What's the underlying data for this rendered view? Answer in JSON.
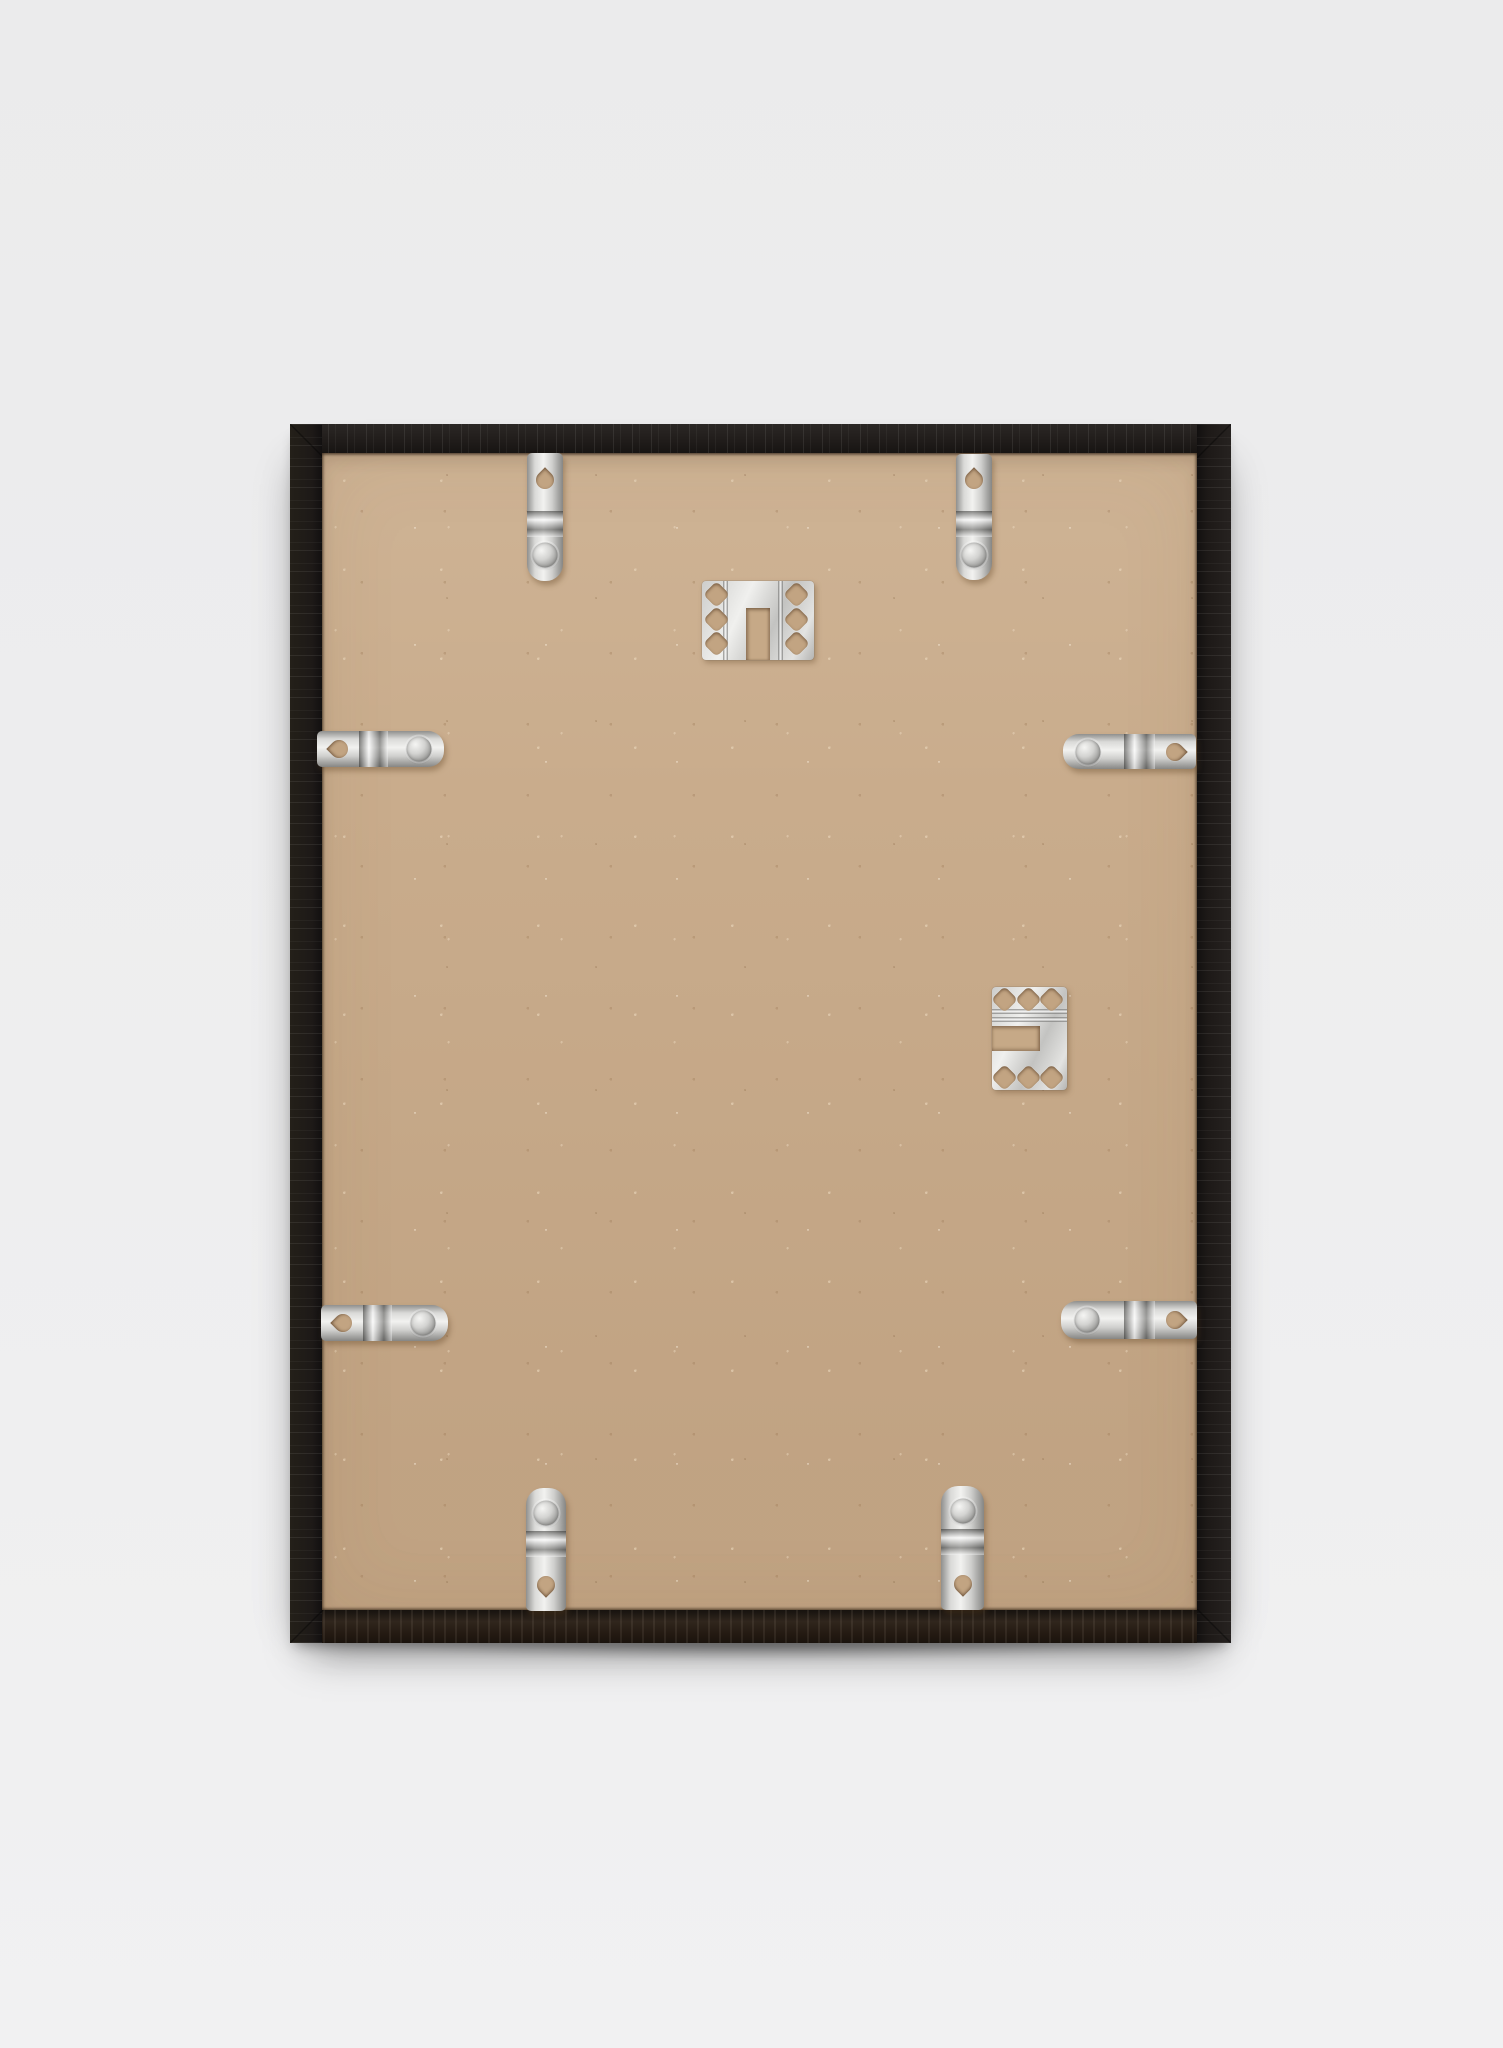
{
  "scene": {
    "type": "photograph",
    "description": "Back view of a black wooden picture frame with a kraft hardboard backing board, leaning against a light grey wall",
    "wall_color": "#ededee",
    "frame_color": "#201c1a",
    "backing_color": "#c9ac8c",
    "metal_color": "#d6d6d4"
  },
  "frame": {
    "label": "picture frame seen from the back",
    "material": "black stained wood with visible grain",
    "backing_label": "kraft hardboard backing board"
  },
  "hardware": {
    "spring_clips": {
      "count": 8,
      "label": "metal spring clip with teardrop hole and round rivet"
    },
    "hanging_brackets": {
      "count": 2,
      "label": "perforated metal hanging bracket with six holes and slot"
    }
  }
}
